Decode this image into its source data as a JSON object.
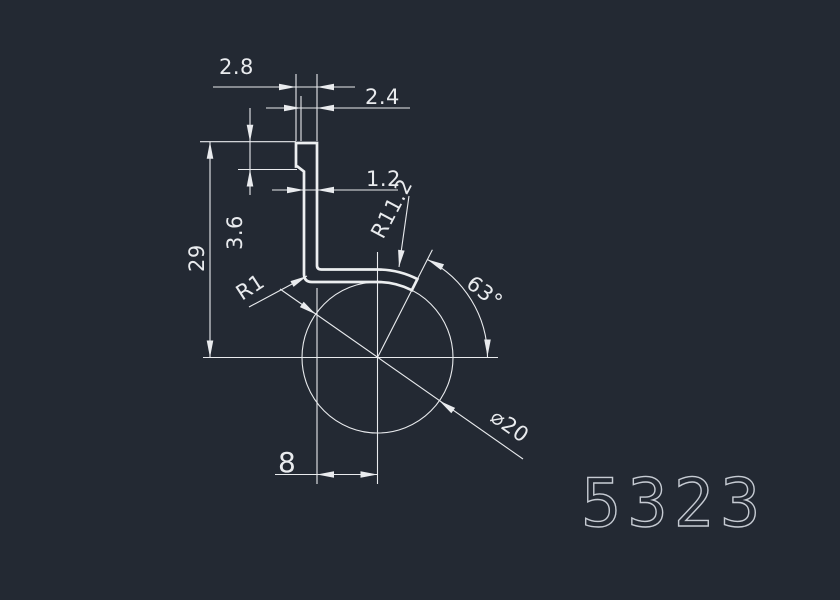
{
  "window": {
    "background_color": "#232933",
    "line_color": "#e9ebee",
    "part_number_color": "#c6cbd3"
  },
  "drawing": {
    "part_number": "5323",
    "dimensions": {
      "tab_width": "2.8",
      "upper_wall_width": "2.4",
      "wall_thickness": "1.2",
      "outer_radius": "R11.2",
      "tab_height": "3.6",
      "overall_height": "29",
      "bend_radius": "R1",
      "end_face_angle": "63°",
      "circle_diameter": "⌀20",
      "horizontal_offset": "8"
    }
  }
}
